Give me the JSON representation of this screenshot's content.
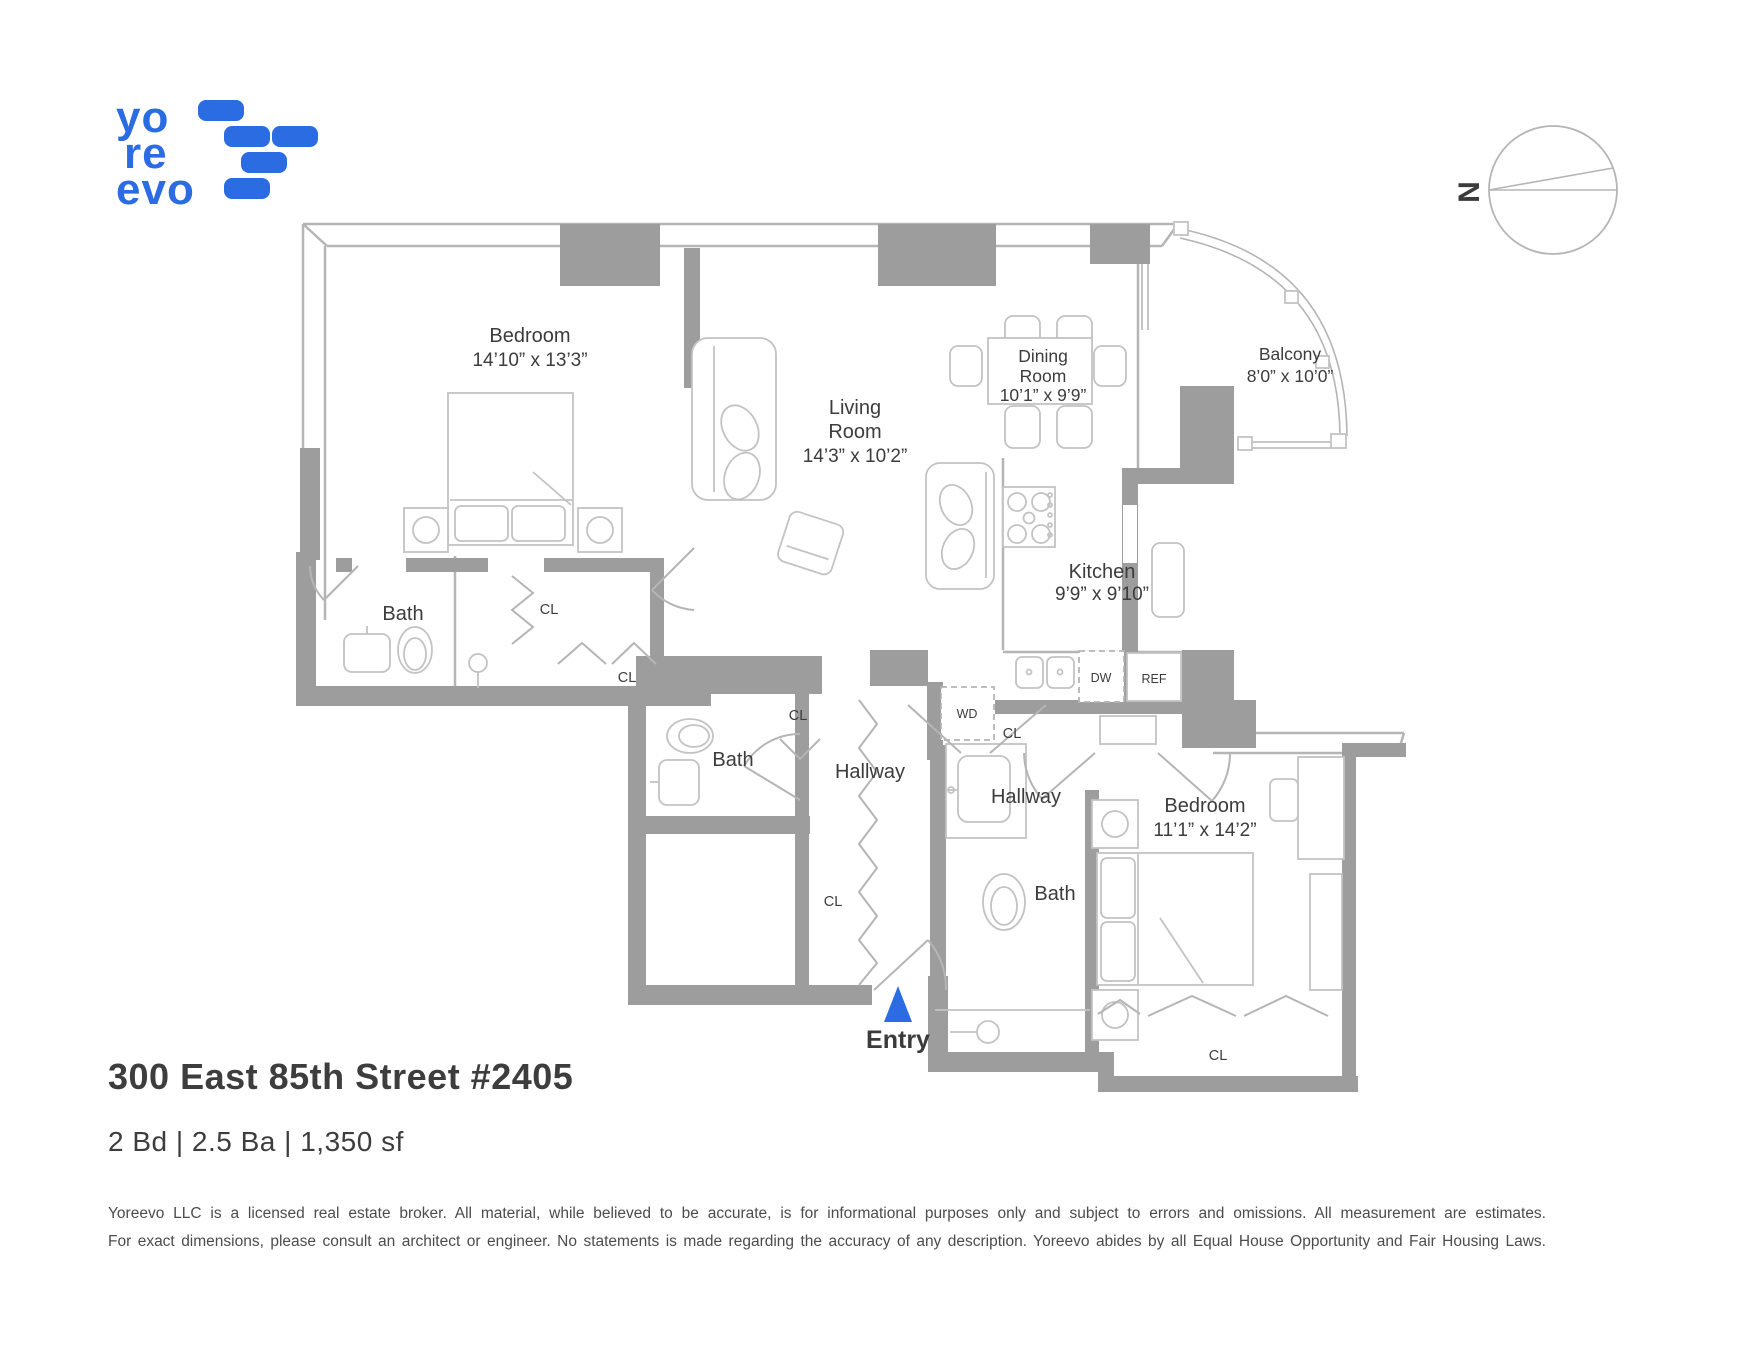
{
  "listing": {
    "address": "300 East 85th Street #2405",
    "specs": "2 Bd | 2.5 Ba | 1,350 sf"
  },
  "logo": {
    "l1": "yo",
    "l2": "re",
    "l3": "evo"
  },
  "compass": {
    "n": "N"
  },
  "rooms": {
    "bedroom1": {
      "name": "Bedroom",
      "dims": "14’10” x 13’3”"
    },
    "living": {
      "l1": "Living",
      "l2": "Room",
      "l3": "14’3” x 10’2”"
    },
    "dining": {
      "l1": "Dining",
      "l2": "Room",
      "l3": "10’1” x 9’9”"
    },
    "balcony": {
      "l1": "Balcony",
      "l2": "8’0” x 10’0”"
    },
    "kitchen": {
      "l1": "Kitchen",
      "l2": "9’9” x 9’10”"
    },
    "bedroom2": {
      "name": "Bedroom",
      "dims": "11’1” x 14’2”"
    },
    "bath1": "Bath",
    "bath2": "Bath",
    "bath3": "Bath",
    "hallway1": "Hallway",
    "hallway2": "Hallway",
    "entry": "Entry"
  },
  "closets": {
    "cl1": "CL",
    "cl2": "CL",
    "cl3": "CL",
    "cl4": "CL",
    "cl5": "CL",
    "cl6": "CL"
  },
  "appliances": {
    "dw": "DW",
    "ref": "REF",
    "wd": "WD"
  },
  "footer": {
    "line1": "Yoreevo LLC is a licensed real estate broker. All material, while believed to be accurate, is for informational purposes only and subject to errors and omissions. All measurement are estimates.",
    "line2": "For exact dimensions, please consult an architect or engineer. No statements is made regarding the accuracy of any description. Yoreevo abides by all Equal House Opportunity and Fair Housing Laws."
  },
  "colors": {
    "brand_blue": "#2b6ce2",
    "wall_gray": "#9d9d9d"
  }
}
